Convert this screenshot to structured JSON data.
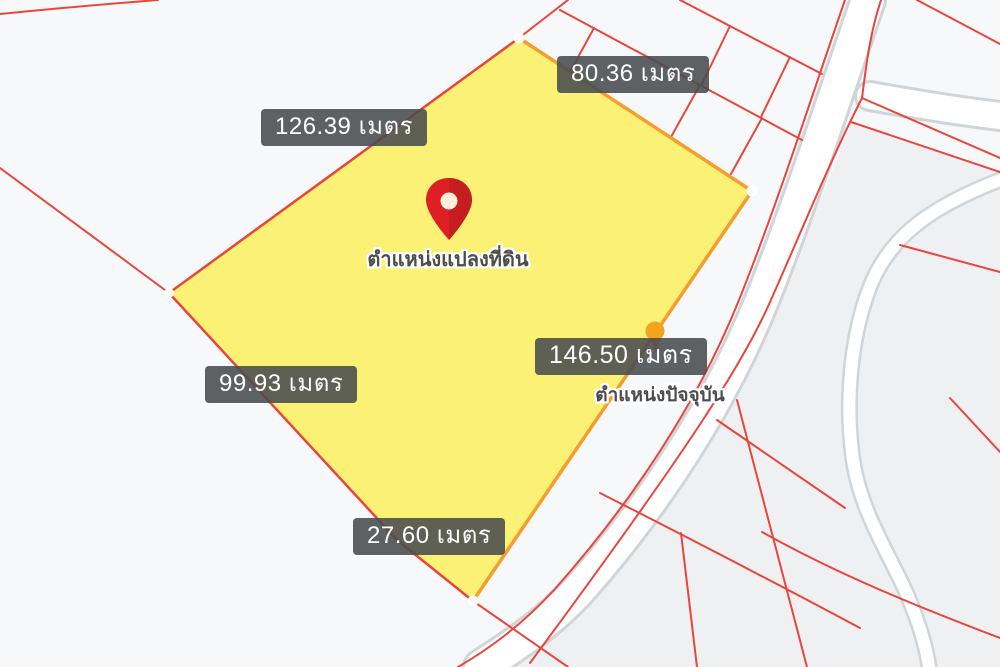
{
  "map": {
    "type": "cadastral-parcel-map",
    "background_color": "#f7f8f9",
    "road_fill_color": "#ffffff",
    "road_edge_color": "#d3d8dc",
    "parcel_line_color": "#e8463c",
    "highlight_parcel": {
      "fill_color": "#fbf170",
      "border_color_main": "#f59e2e",
      "border_color_secondary": "#e8463c",
      "pin_color": "#df1f26",
      "pin_label": "ตำแหน่งแปลงที่ดิน",
      "side_measurements": {
        "top_left": "126.39 เมตร",
        "top_right": "80.36 เมตร",
        "right": "146.50 เมตร",
        "bottom_left": "99.93 เมตร",
        "bottom": "27.60 เมตร"
      }
    },
    "current_position": {
      "label": "ตำแหน่งปัจจุบัน",
      "marker_color": "#f2a41f"
    },
    "measurement_label_style": {
      "background": "rgba(72,75,79,0.88)",
      "text_color": "#ffffff"
    }
  }
}
